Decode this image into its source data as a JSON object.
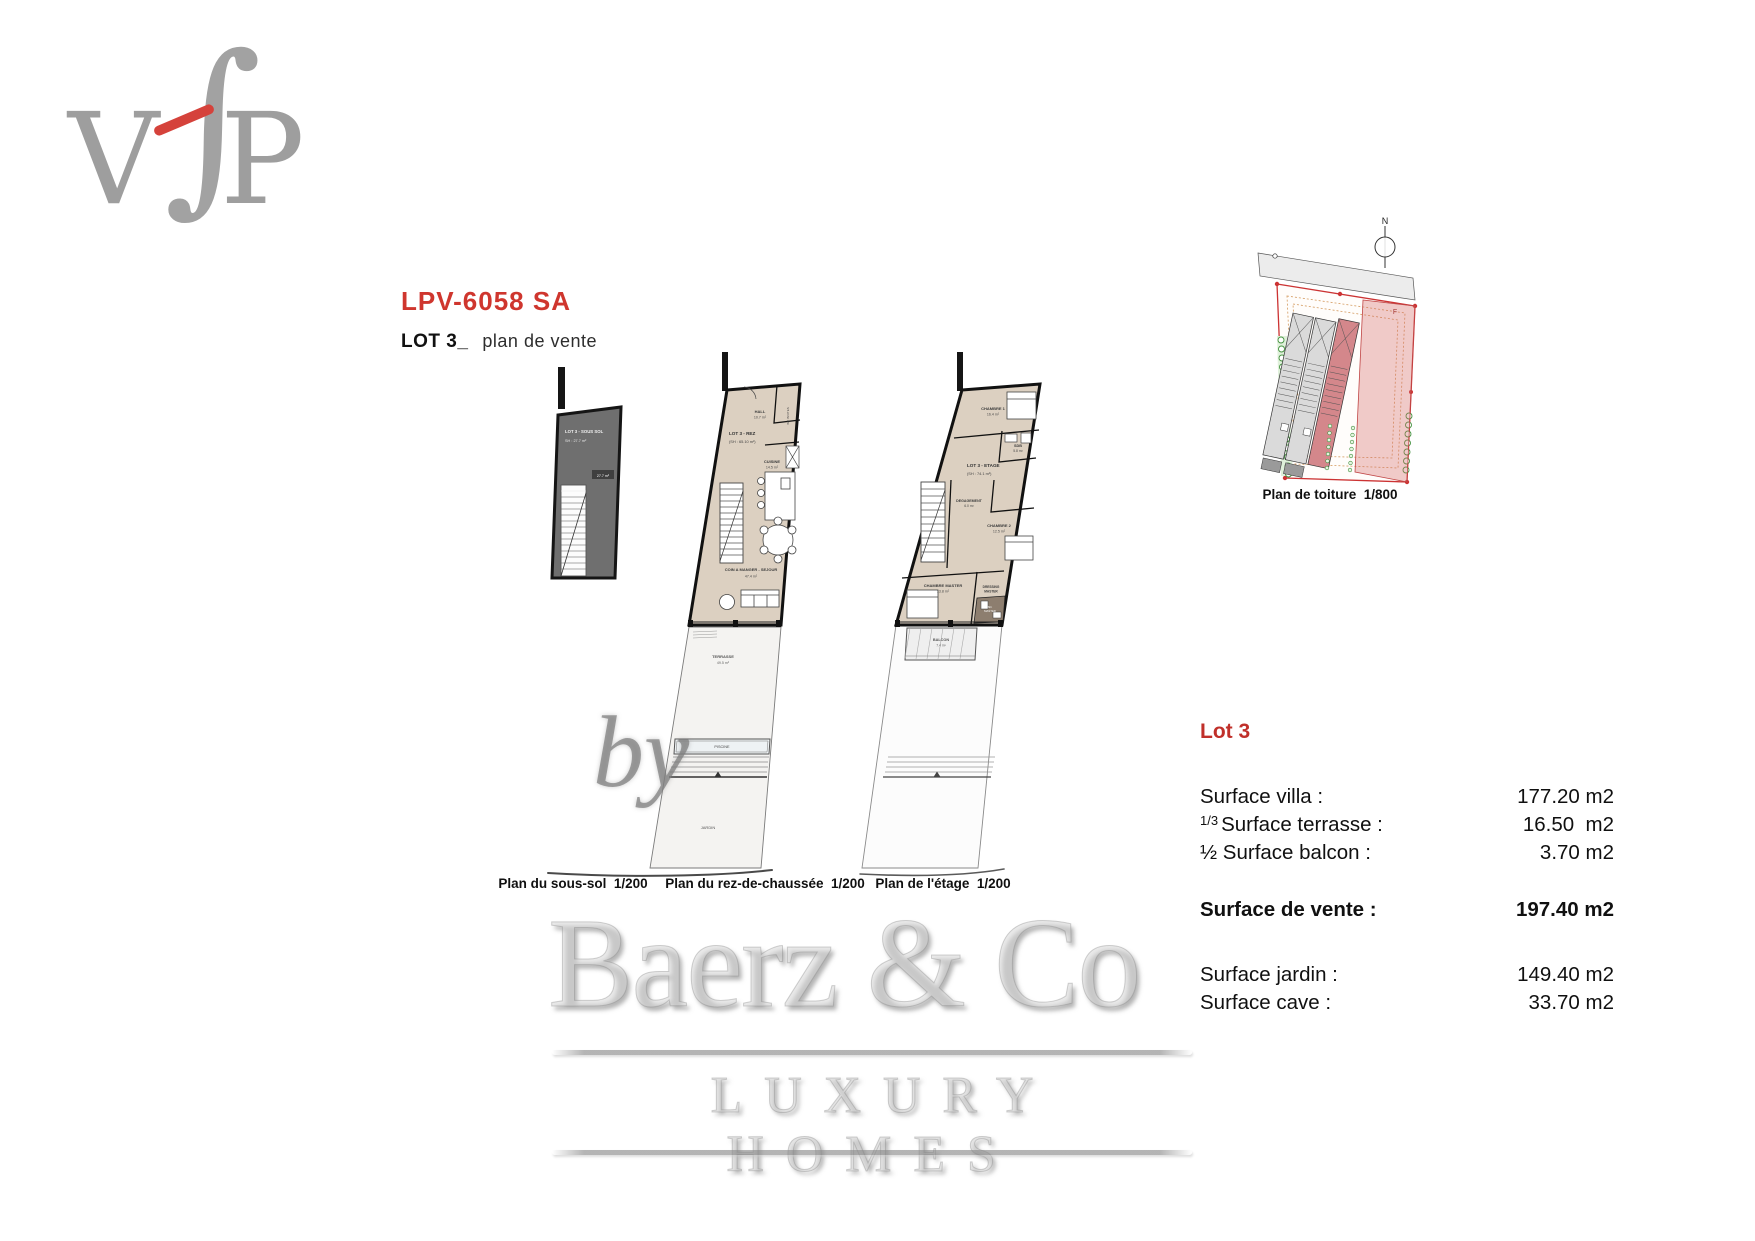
{
  "logo": {
    "letter_v": "V",
    "letter_f": "∫",
    "letter_p": "P"
  },
  "header": {
    "project_code": "LPV-6058 SA",
    "lot_title": "LOT 3_",
    "subtitle": "plan de vente"
  },
  "plans": {
    "sous_sol": {
      "caption": "Plan du sous-sol  1/200",
      "lot_label": "LOT 3 - SOUS SOL",
      "lot_area": "SH : 27.7 m²",
      "badge": "27.7 m²"
    },
    "rdc": {
      "caption": "Plan du rez-de-chaussée  1/200",
      "lot_label": "LOT 3 - REZ",
      "lot_area": "(SH : 65.10 m²)",
      "hall_name": "HALL",
      "hall_area": "10.7 m²",
      "wc_name": "WC INVITES",
      "cuisine_name": "CUISINE",
      "cuisine_area": "14.5 m²",
      "sejour_name": "COIN A MANGER - SEJOUR",
      "sejour_area": "47.4 m²",
      "terrasse_name": "TERRASSE",
      "terrasse_area": "49.5 m²",
      "piscine_name": "PISCINE",
      "jardin_name": "JARDIN"
    },
    "etage": {
      "caption": "Plan de l'étage  1/200",
      "lot_label": "LOT 3 - ETAGE",
      "lot_area": "(SH : 74.1 m²)",
      "chambre1_name": "CHAMBRE 1",
      "chambre1_area": "16.4 m²",
      "sdb_name": "SDB",
      "sdb_area": "5.8 m²",
      "degagement_name": "DEGAGEMENT",
      "degagement_area": "6.0 m²",
      "chambre2_name": "CHAMBRE 2",
      "chambre2_area": "12.5 m²",
      "master_name": "CHAMBRE MASTER",
      "master_area": "13.8 m²",
      "dressing_line1": "DRESSING",
      "dressing_line2": "MASTER",
      "sde_line1": "SD.",
      "sde_line2": "MASTER",
      "balcon_name": "BALCON",
      "balcon_area": "7.4 m²"
    }
  },
  "roof": {
    "caption": "Plan de toiture  1/800",
    "north_label": "N",
    "zone_label": "F"
  },
  "surfaces": {
    "title": "Lot 3",
    "rows": [
      {
        "prefix": "",
        "label": "Surface villa :",
        "value": "177.20 m2"
      },
      {
        "prefix": "1/3",
        "label": "Surface terrasse :",
        "value": "16.50  m2"
      },
      {
        "prefix": "",
        "label": "½ Surface balcon :",
        "value": "3.70 m2"
      },
      {
        "prefix": "",
        "label": "Surface de vente :",
        "value": "197.40 m2"
      },
      {
        "prefix": "",
        "label": "Surface jardin :",
        "value": "149.40 m2"
      },
      {
        "prefix": "",
        "label": "Surface cave :",
        "value": "33.70 m2"
      }
    ]
  },
  "watermark": {
    "by_text": "by",
    "brand": "Baerz & Co",
    "tagline": "LUXURY HOMES"
  },
  "colors": {
    "accent_red": "#cf362e",
    "plan_beige": "#dcd0c1",
    "basement_gray": "#6f6f6f",
    "lot3_pink": "#d4878b"
  }
}
